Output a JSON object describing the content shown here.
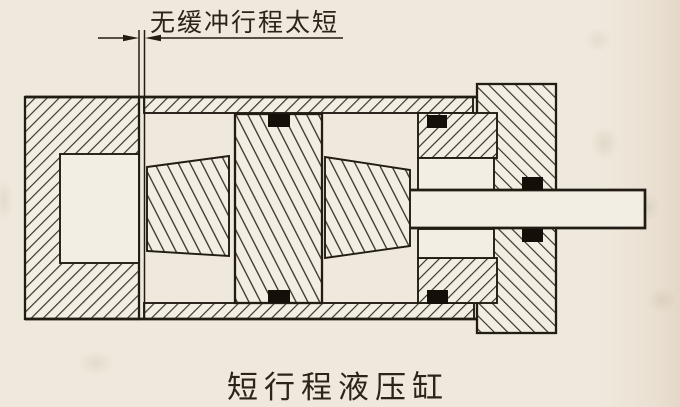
{
  "figure": {
    "annotation_label": "无缓冲行程太短",
    "caption": "短行程液压缸"
  },
  "theme": {
    "paper": "#efe9dd",
    "part-bg": "#f3eee4",
    "ink": "#231c14",
    "hatch": "#372e23",
    "seal": "#141009",
    "text": "#2b241a"
  }
}
